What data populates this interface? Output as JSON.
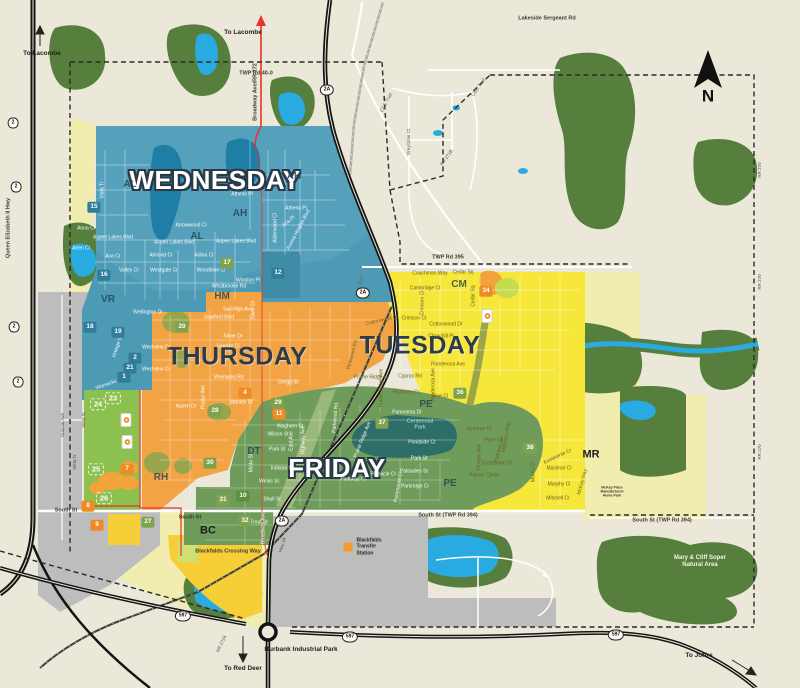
{
  "title": "Blackfalds collection day zone map",
  "zone_colors": {
    "wednesday": "#4D9AB5",
    "thursday": "#F2A444",
    "tuesday": "#F7E73B",
    "friday": "#6F9C5B",
    "future": "#F0EDAF",
    "commercial": "#F6CE38",
    "industrial": "#BDBDBD",
    "development": "#8CC04F",
    "water": "#29ABE2",
    "forest": "#567F3E"
  },
  "labels": [
    {
      "t": "WEDNESDAY",
      "x": 215,
      "y": 180,
      "c": "dayW",
      "n": "zone-title-wednesday"
    },
    {
      "t": "THURSDAY",
      "x": 237,
      "y": 357,
      "c": "dayD",
      "n": "zone-title-thursday"
    },
    {
      "t": "TUESDAY",
      "x": 420,
      "y": 346,
      "c": "dayD",
      "n": "zone-title-tuesday"
    },
    {
      "t": "FRIDAY",
      "x": 337,
      "y": 468,
      "c": "dayW",
      "n": "zone-title-friday"
    },
    {
      "t": "N",
      "x": 708,
      "y": 96,
      "c": "north",
      "n": "north-label"
    },
    {
      "t": "AL",
      "x": 130,
      "y": 185,
      "c": "area"
    },
    {
      "t": "AH",
      "x": 240,
      "y": 214,
      "c": "area"
    },
    {
      "t": "AL",
      "x": 197,
      "y": 237,
      "c": "area"
    },
    {
      "t": "AH",
      "x": 294,
      "y": 177,
      "c": "area"
    },
    {
      "t": "VR",
      "x": 108,
      "y": 300,
      "c": "area"
    },
    {
      "t": "HM",
      "x": 222,
      "y": 297,
      "c": "area"
    },
    {
      "t": "CM",
      "x": 459,
      "y": 285,
      "c": "area"
    },
    {
      "t": "PE",
      "x": 426,
      "y": 405,
      "c": "area"
    },
    {
      "t": "PE",
      "x": 450,
      "y": 484,
      "c": "area"
    },
    {
      "t": "DT",
      "x": 254,
      "y": 452,
      "c": "area"
    },
    {
      "t": "RH",
      "x": 161,
      "y": 478,
      "c": "area"
    },
    {
      "t": "MR",
      "x": 591,
      "y": 455,
      "c": "areaB"
    },
    {
      "t": "BC",
      "x": 208,
      "y": 531,
      "c": "areaB"
    },
    {
      "t": "To Lacombe",
      "x": 42,
      "y": 54,
      "c": "dest",
      "n": "dest-lacombe-west"
    },
    {
      "t": "To Lacombe",
      "x": 243,
      "y": 33,
      "c": "dest",
      "n": "dest-lacombe-broadway"
    },
    {
      "t": "To Red Deer",
      "x": 243,
      "y": 669,
      "c": "dest",
      "n": "dest-red-deer"
    },
    {
      "t": "To Joffre",
      "x": 699,
      "y": 656,
      "c": "dest",
      "n": "dest-joffre"
    },
    {
      "t": "Burbank Industrial Park",
      "x": 301,
      "y": 650,
      "c": "dest",
      "n": "burbank-industrial-park"
    },
    {
      "t": "Mary & Cliff Soper\nNatural Area",
      "x": 700,
      "y": 562,
      "c": "nat",
      "n": "natural-area-label"
    },
    {
      "t": "Blackfalds\nTransfer\nStation",
      "x": 369,
      "y": 547,
      "c": "tfs",
      "n": "transfer-station-label"
    },
    {
      "t": "McKay Place\nManufactured\nHome Park",
      "x": 612,
      "y": 492,
      "c": "mk3"
    },
    {
      "t": "Blackfalds Crossing Way",
      "x": 228,
      "y": 552,
      "c": "rd"
    },
    {
      "t": "Centennial\nPark",
      "x": 420,
      "y": 425,
      "c": "park",
      "n": "centennial-park-label"
    },
    {
      "t": "TWP Rd 40-0",
      "x": 256,
      "y": 74,
      "c": "rd"
    },
    {
      "t": "Lakeside Sergeant Rd",
      "x": 547,
      "y": 19,
      "c": "rd"
    },
    {
      "t": "TWP Rd 395",
      "x": 448,
      "y": 258,
      "c": "rd"
    },
    {
      "t": "South St",
      "x": 66,
      "y": 511,
      "c": "rd"
    },
    {
      "t": "South St",
      "x": 190,
      "y": 518,
      "c": "rd"
    },
    {
      "t": "South St (TWP Rd 394)",
      "x": 448,
      "y": 516,
      "c": "rd"
    },
    {
      "t": "South St (TWP Rd 394)",
      "x": 662,
      "y": 521,
      "c": "rd"
    },
    {
      "t": "Queen Elizabeth II Hwy",
      "x": 9,
      "y": 228,
      "c": "rd",
      "r": -90
    },
    {
      "t": "Broadway Ave/RR 272",
      "x": 256,
      "y": 92,
      "c": "rd",
      "r": -90
    },
    {
      "t": "C&E Trail",
      "x": 387,
      "y": 103,
      "c": "stD",
      "r": -62
    },
    {
      "t": "C&E Trail",
      "x": 479,
      "y": 88,
      "c": "stD",
      "r": -55
    },
    {
      "t": "C&E Trail",
      "x": 361,
      "y": 286,
      "c": "stD",
      "r": -80
    },
    {
      "t": "RR 271B",
      "x": 447,
      "y": 158,
      "c": "tiny",
      "r": -55
    },
    {
      "t": "Greystone Ct",
      "x": 409,
      "y": 142,
      "c": "tiny",
      "r": -90
    },
    {
      "t": "RR 270",
      "x": 760,
      "y": 170,
      "c": "tiny",
      "r": -90
    },
    {
      "t": "RR 270",
      "x": 760,
      "y": 282,
      "c": "tiny",
      "r": -90
    },
    {
      "t": "RR 270",
      "x": 760,
      "y": 452,
      "c": "tiny",
      "r": -90
    },
    {
      "t": "RR 272A",
      "x": 222,
      "y": 644,
      "c": "tiny",
      "r": -65
    },
    {
      "t": "Hwy 2A",
      "x": 283,
      "y": 545,
      "c": "tiny",
      "r": -72
    },
    {
      "t": "Duncan Ave",
      "x": 63,
      "y": 425,
      "c": "tiny",
      "r": -90
    },
    {
      "t": "Vista Tr",
      "x": 84,
      "y": 420,
      "c": "tiny",
      "r": -90
    },
    {
      "t": "Vista Tr",
      "x": 75,
      "y": 462,
      "c": "tiny",
      "r": -90
    },
    {
      "t": "Vista Tr",
      "x": 103,
      "y": 190,
      "c": "st",
      "r": -90
    },
    {
      "t": "Anna Cl",
      "x": 86,
      "y": 229,
      "c": "st"
    },
    {
      "t": "Aspen Lakes Blvd",
      "x": 113,
      "y": 238,
      "c": "st"
    },
    {
      "t": "Arlen Cl",
      "x": 81,
      "y": 249,
      "c": "st"
    },
    {
      "t": "Ava Cr",
      "x": 113,
      "y": 257,
      "c": "st"
    },
    {
      "t": "Valley Cr",
      "x": 129,
      "y": 271,
      "c": "st"
    },
    {
      "t": "Aspen Lakes Blvd",
      "x": 174,
      "y": 243,
      "c": "st"
    },
    {
      "t": "Almond Cr",
      "x": 161,
      "y": 256,
      "c": "st"
    },
    {
      "t": "Westgate Cr",
      "x": 164,
      "y": 271,
      "c": "st"
    },
    {
      "t": "Arrowwood Cl",
      "x": 191,
      "y": 226,
      "c": "st"
    },
    {
      "t": "Adina Cl",
      "x": 204,
      "y": 256,
      "c": "st"
    },
    {
      "t": "Woodbine Cl",
      "x": 211,
      "y": 271,
      "c": "st"
    },
    {
      "t": "Aspen Lakes Blvd",
      "x": 236,
      "y": 242,
      "c": "st"
    },
    {
      "t": "Winston Pl",
      "x": 248,
      "y": 281,
      "c": "st"
    },
    {
      "t": "Westbrooke Rd",
      "x": 229,
      "y": 287,
      "c": "st"
    },
    {
      "t": "Athena Pl",
      "x": 296,
      "y": 209,
      "c": "st"
    },
    {
      "t": "Aurora Heights Blvd",
      "x": 299,
      "y": 230,
      "c": "st",
      "r": -62
    },
    {
      "t": "Alderwood Cl",
      "x": 276,
      "y": 228,
      "c": "st",
      "r": -90
    },
    {
      "t": "Aria Pl",
      "x": 289,
      "y": 222,
      "c": "st",
      "r": -40
    },
    {
      "t": "Athens Pl",
      "x": 242,
      "y": 195,
      "c": "st"
    },
    {
      "t": "Wellington Dr",
      "x": 148,
      "y": 313,
      "c": "st"
    },
    {
      "t": "Sunridge Ave",
      "x": 238,
      "y": 310,
      "c": "st"
    },
    {
      "t": "Stanford Blvd",
      "x": 219,
      "y": 318,
      "c": "st"
    },
    {
      "t": "Silver Dr",
      "x": 233,
      "y": 337,
      "c": "st"
    },
    {
      "t": "Silver Dr",
      "x": 254,
      "y": 310,
      "c": "st",
      "r": -90
    },
    {
      "t": "Sunrise Cl",
      "x": 228,
      "y": 347,
      "c": "st"
    },
    {
      "t": "Westview Cr",
      "x": 156,
      "y": 348,
      "c": "st"
    },
    {
      "t": "Westview Cr",
      "x": 156,
      "y": 370,
      "c": "st"
    },
    {
      "t": "Womacks Rd",
      "x": 229,
      "y": 378,
      "c": "st"
    },
    {
      "t": "Womacks Rd",
      "x": 110,
      "y": 384,
      "c": "st",
      "r": -20
    },
    {
      "t": "Vintage Cl",
      "x": 118,
      "y": 347,
      "c": "st",
      "r": -72
    },
    {
      "t": "Aspen Dr",
      "x": 186,
      "y": 407,
      "c": "st"
    },
    {
      "t": "Poplar Ave",
      "x": 204,
      "y": 397,
      "c": "st",
      "r": -90
    },
    {
      "t": "Stanley St",
      "x": 241,
      "y": 403,
      "c": "st"
    },
    {
      "t": "Gregg St",
      "x": 288,
      "y": 383,
      "c": "st"
    },
    {
      "t": "Coachman Way",
      "x": 430,
      "y": 274,
      "c": "stB"
    },
    {
      "t": "Cedar Sq",
      "x": 463,
      "y": 273,
      "c": "stB"
    },
    {
      "t": "Cambridge Cl",
      "x": 425,
      "y": 289,
      "c": "stB"
    },
    {
      "t": "Crimson Cl",
      "x": 423,
      "y": 303,
      "c": "stB",
      "r": -90
    },
    {
      "t": "Crimson Ct",
      "x": 414,
      "y": 319,
      "c": "stB"
    },
    {
      "t": "Cottonwood Dr",
      "x": 382,
      "y": 321,
      "c": "stB",
      "r": -12
    },
    {
      "t": "Cottonwood Dr",
      "x": 446,
      "y": 325,
      "c": "stB"
    },
    {
      "t": "Churchill Pl",
      "x": 441,
      "y": 337,
      "c": "stB"
    },
    {
      "t": "Cedar Sq",
      "x": 474,
      "y": 296,
      "c": "stB",
      "r": -90
    },
    {
      "t": "Ponderosa Ave",
      "x": 448,
      "y": 365,
      "c": "stB"
    },
    {
      "t": "Ponderosa Ave",
      "x": 434,
      "y": 385,
      "c": "stB",
      "r": -90
    },
    {
      "t": "Cyprus Rd",
      "x": 410,
      "y": 377,
      "c": "stB"
    },
    {
      "t": "Plumtree Cr",
      "x": 406,
      "y": 393,
      "c": "stB"
    },
    {
      "t": "Prairie Ridge Ave",
      "x": 382,
      "y": 388,
      "c": "stB",
      "r": -90
    },
    {
      "t": "Prairie Ridge Cl",
      "x": 371,
      "y": 378,
      "c": "stB"
    },
    {
      "t": "Pinewood Rd",
      "x": 353,
      "y": 355,
      "c": "stB",
      "r": -75
    },
    {
      "t": "Pine Cl",
      "x": 440,
      "y": 397,
      "c": "stB"
    },
    {
      "t": "Pinetree Cl",
      "x": 479,
      "y": 430,
      "c": "stB"
    },
    {
      "t": "Piper Cl",
      "x": 493,
      "y": 441,
      "c": "stB"
    },
    {
      "t": "Parkway Dr",
      "x": 500,
      "y": 450,
      "c": "stB",
      "r": -75
    },
    {
      "t": "Palmer Circle",
      "x": 484,
      "y": 476,
      "c": "stB"
    },
    {
      "t": "Pioneer Ave",
      "x": 480,
      "y": 457,
      "c": "stB",
      "r": -90
    },
    {
      "t": "Eastpointe Dr",
      "x": 497,
      "y": 464,
      "c": "stB"
    },
    {
      "t": "Eastpointe Cr",
      "x": 558,
      "y": 457,
      "c": "stB",
      "r": -25
    },
    {
      "t": "McKinley Way",
      "x": 507,
      "y": 437,
      "c": "stB",
      "r": -80
    },
    {
      "t": "Maclean Cl",
      "x": 559,
      "y": 469,
      "c": "stB"
    },
    {
      "t": "Murphy Cl",
      "x": 559,
      "y": 485,
      "c": "stB"
    },
    {
      "t": "Mitchell Cr",
      "x": 558,
      "y": 499,
      "c": "stB"
    },
    {
      "t": "McKay Way",
      "x": 583,
      "y": 482,
      "c": "stB",
      "r": -75
    },
    {
      "t": "Morris Cl",
      "x": 534,
      "y": 472,
      "c": "stB",
      "r": -90
    },
    {
      "t": "Panorama Dr",
      "x": 407,
      "y": 413,
      "c": "st"
    },
    {
      "t": "Pondside Cr",
      "x": 422,
      "y": 443,
      "c": "st"
    },
    {
      "t": "Park St",
      "x": 419,
      "y": 459,
      "c": "st"
    },
    {
      "t": "Palisades St",
      "x": 414,
      "y": 472,
      "c": "st"
    },
    {
      "t": "Parkridge Cr",
      "x": 415,
      "y": 487,
      "c": "st"
    },
    {
      "t": "Pinnacle Cl",
      "x": 383,
      "y": 475,
      "c": "st"
    },
    {
      "t": "Parkway Cl",
      "x": 353,
      "y": 480,
      "c": "st"
    },
    {
      "t": "Parkwood Rd",
      "x": 336,
      "y": 418,
      "c": "st",
      "r": -85
    },
    {
      "t": "Prairie Ridge Ave",
      "x": 363,
      "y": 440,
      "c": "st",
      "r": -68
    },
    {
      "t": "Paramount Cr",
      "x": 399,
      "y": 487,
      "c": "st",
      "r": -80
    },
    {
      "t": "Waghorn St",
      "x": 290,
      "y": 427,
      "c": "st"
    },
    {
      "t": "Wilson St",
      "x": 278,
      "y": 435,
      "c": "st"
    },
    {
      "t": "Park St",
      "x": 277,
      "y": 450,
      "c": "st"
    },
    {
      "t": "East Ave",
      "x": 292,
      "y": 441,
      "c": "st",
      "r": -90
    },
    {
      "t": "Highway Ave",
      "x": 304,
      "y": 440,
      "c": "st",
      "r": -90
    },
    {
      "t": "Minto St",
      "x": 252,
      "y": 463,
      "c": "st",
      "r": -90
    },
    {
      "t": "Indiana St",
      "x": 282,
      "y": 469,
      "c": "st"
    },
    {
      "t": "Winks St",
      "x": 269,
      "y": 482,
      "c": "st"
    },
    {
      "t": "Shull St",
      "x": 272,
      "y": 500,
      "c": "st"
    },
    {
      "t": "Trout St",
      "x": 259,
      "y": 523,
      "c": "st"
    },
    {
      "t": "Broadway Ave",
      "x": 264,
      "y": 528,
      "c": "st",
      "r": -90
    }
  ],
  "markers": [
    {
      "t": "15",
      "x": 94,
      "y": 207,
      "bg": "teal"
    },
    {
      "t": "16",
      "x": 104,
      "y": 275,
      "bg": "teal"
    },
    {
      "t": "12",
      "x": 278,
      "y": 273,
      "bg": "teal"
    },
    {
      "t": "18",
      "x": 90,
      "y": 327,
      "bg": "teal"
    },
    {
      "t": "19",
      "x": 118,
      "y": 332,
      "bg": "teal"
    },
    {
      "t": "2",
      "x": 135,
      "y": 358,
      "bg": "teal"
    },
    {
      "t": "21",
      "x": 130,
      "y": 368,
      "bg": "teal"
    },
    {
      "t": "1",
      "x": 124,
      "y": 377,
      "bg": "teal"
    },
    {
      "t": "17",
      "x": 227,
      "y": 263,
      "bg": "green"
    },
    {
      "t": "20",
      "x": 182,
      "y": 327,
      "bg": "green"
    },
    {
      "t": "27",
      "x": 148,
      "y": 522,
      "bg": "green"
    },
    {
      "t": "28",
      "x": 215,
      "y": 411,
      "bg": "green"
    },
    {
      "t": "29",
      "x": 278,
      "y": 403,
      "bg": "green"
    },
    {
      "t": "11",
      "x": 279,
      "y": 414,
      "bg": "orange"
    },
    {
      "t": "30",
      "x": 210,
      "y": 463,
      "bg": "green"
    },
    {
      "t": "31",
      "x": 223,
      "y": 500,
      "bg": "green"
    },
    {
      "t": "10",
      "x": 243,
      "y": 496,
      "bg": "greenD"
    },
    {
      "t": "32",
      "x": 245,
      "y": 521,
      "bg": "green"
    },
    {
      "t": "36",
      "x": 460,
      "y": 393,
      "bg": "green"
    },
    {
      "t": "37",
      "x": 382,
      "y": 423,
      "bg": "green"
    },
    {
      "t": "38",
      "x": 530,
      "y": 448,
      "bg": "green"
    },
    {
      "t": "4",
      "x": 245,
      "y": 393,
      "bg": "orange"
    },
    {
      "t": "34",
      "x": 486,
      "y": 291,
      "bg": "orange"
    },
    {
      "t": "7",
      "x": 127,
      "y": 469,
      "bg": "orange"
    },
    {
      "t": "8",
      "x": 88,
      "y": 506,
      "bg": "orange"
    },
    {
      "t": "9",
      "x": 97,
      "y": 525,
      "bg": "orange"
    },
    {
      "t": "23",
      "x": 113,
      "y": 398,
      "bg": "dashed"
    },
    {
      "t": "24",
      "x": 98,
      "y": 404,
      "bg": "dashed"
    },
    {
      "t": "25",
      "x": 96,
      "y": 469,
      "bg": "dashed"
    },
    {
      "t": "26",
      "x": 104,
      "y": 498,
      "bg": "dashed"
    }
  ],
  "marker_colors": {
    "teal": "#2F7D99",
    "green": "#7FA34D",
    "greenD": "#5E8F3E",
    "orange": "#F08A24",
    "dashed": "transparent"
  },
  "shields": [
    {
      "t": "2",
      "x": 13,
      "y": 123
    },
    {
      "t": "2",
      "x": 16,
      "y": 187
    },
    {
      "t": "2",
      "x": 14,
      "y": 327
    },
    {
      "t": "2",
      "x": 18,
      "y": 382
    },
    {
      "t": "2A",
      "x": 327,
      "y": 90
    },
    {
      "t": "2A",
      "x": 363,
      "y": 293
    },
    {
      "t": "2A",
      "x": 282,
      "y": 521
    },
    {
      "t": "597",
      "x": 183,
      "y": 616
    },
    {
      "t": "597",
      "x": 350,
      "y": 637
    },
    {
      "t": "597",
      "x": 616,
      "y": 635
    }
  ],
  "logos": [
    {
      "x": 126,
      "y": 420
    },
    {
      "x": 127,
      "y": 442
    },
    {
      "x": 487,
      "y": 316
    }
  ],
  "poi_icons": [
    {
      "n": "transfer-station-icon",
      "x": 348,
      "y": 547
    }
  ]
}
